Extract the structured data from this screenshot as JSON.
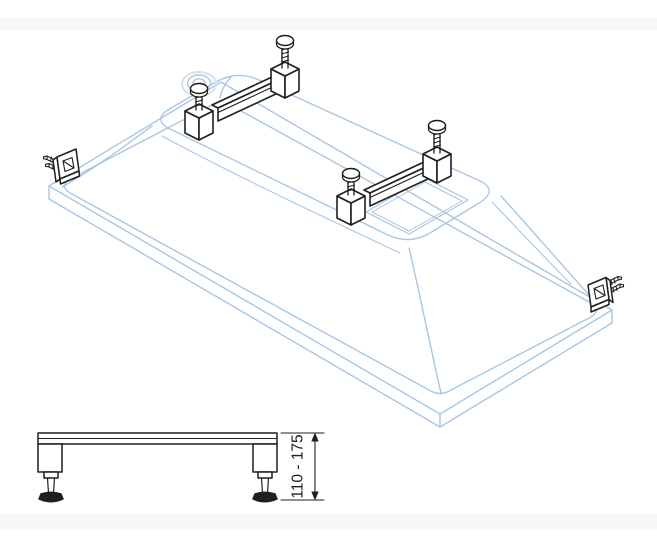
{
  "side_view": {
    "dimension_label": "110 - 175"
  },
  "colors": {
    "outline_blue": "#a9c6e2",
    "outline_blue_light": "#d3e2f1",
    "hardware_black": "#1f1f1f",
    "background": "#ffffff",
    "band_gray": "#f7f7f7",
    "foot_pad_fill": "#1f1f1f"
  },
  "parts": {
    "isometric_view": [
      "inverted-bathtub-rim",
      "bathtub-body",
      "drain-recess",
      "reinforcement-pad",
      "mounting-rail-near-drain",
      "mounting-rail-center",
      "thumb-screws",
      "corner-wall-bracket-left",
      "corner-wall-bracket-right"
    ],
    "side_view": [
      "support-rail-profile",
      "adjustable-foot-left",
      "adjustable-foot-right",
      "height-dimension-line"
    ]
  }
}
